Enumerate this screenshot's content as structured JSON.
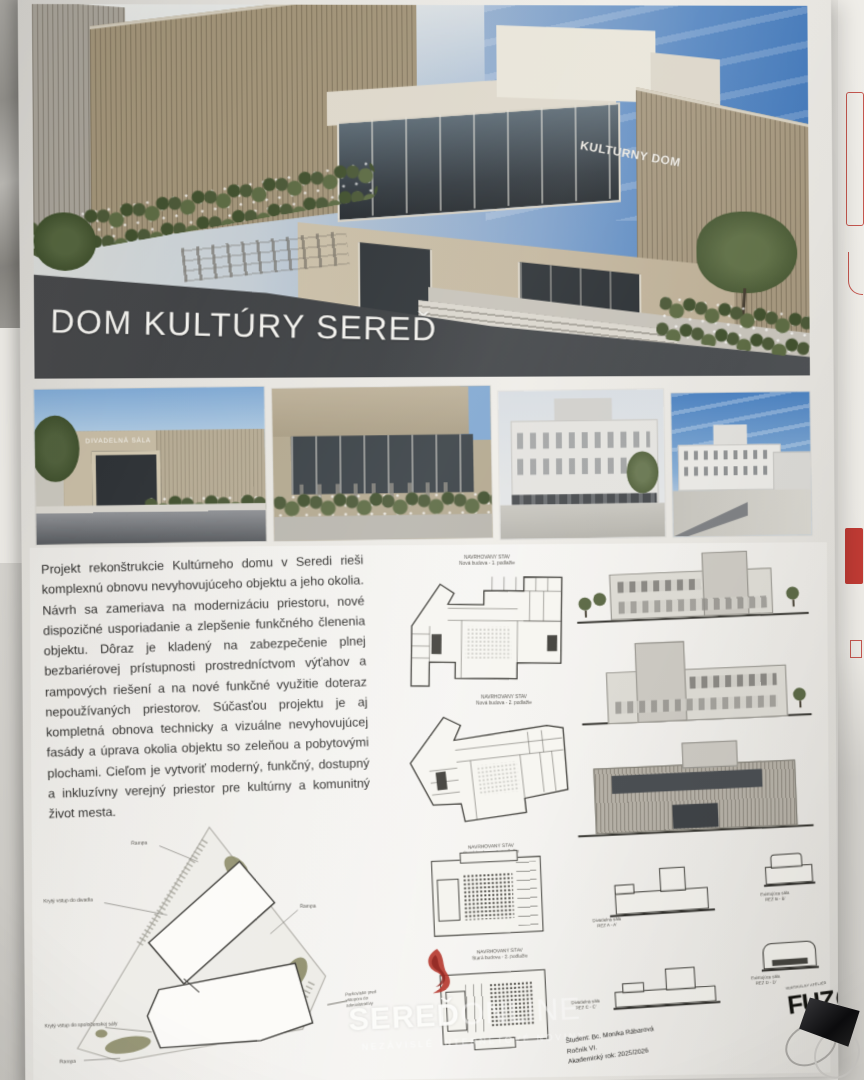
{
  "poster": {
    "hero": {
      "building_sign": "KULTURNY DOM",
      "title": "DOM KULTÚRY SEREĎ"
    },
    "thumbnails": {
      "theatre_sign": "DIVADELNÁ SÁLA"
    },
    "description": "Projekt rekonštrukcie Kultúrneho domu v Seredi rieši komplexnú obnovu nevyhovujúceho objektu a jeho okolia. Návrh sa zameriava na modernizáciu priestoru, nové dispozičné usporiadanie a zlepšenie funkčného členenia objektu. Dôraz je kladený na zabezpečenie plnej bezbariérovej prístupnosti prostredníctvom výťahov a rampových riešení a na nové funkčné využitie doteraz nepoužívaných priestorov. Súčasťou projektu je aj kompletná obnova technicky a vizuálne nevyhovujúcej fasády a úprava okolia objektu so zeleňou a pobytovými plochami. Cieľom je vytvoriť moderný, funkčný, dostupný a inkluzívny verejný priestor pre kultúrny a komunitný život mesta.",
    "plan_labels": [
      {
        "line1": "NAVRHOVANÝ STAV",
        "line2": "Nová budova - 1. podlažie"
      },
      {
        "line1": "NAVRHOVANÝ STAV",
        "line2": "Nová budova - 2. podlažie"
      },
      {
        "line1": "NAVRHOVANÝ STAV",
        "line2": "Stará budova - 1. podlažie"
      },
      {
        "line1": "NAVRHOVANÝ STAV",
        "line2": "Stará budova - 2. podlažie"
      }
    ],
    "site_plan": {
      "labels": {
        "ramp_top": "Rampa",
        "entry_theatre": "Krytý vstup do divadla",
        "ramp_right": "Rampa",
        "entry_hall": "Krytý vstup do spoločenskej sály",
        "ramp_bottom": "Rampa",
        "parking": "Parkovisko pred vstupom do administratívy"
      }
    },
    "section_labels": [
      {
        "line1": "Divadelná sála",
        "line2": "REZ A - A'"
      },
      {
        "line1": "Existujúca sála",
        "line2": "REZ B - B'"
      },
      {
        "line1": "Divadelná sála",
        "line2": "REZ C - C'"
      },
      {
        "line1": "Existujúca sála",
        "line2": "REZ D - D'"
      }
    ],
    "watermark": {
      "brand_strong": "SEREĎ",
      "brand_light": "ONLINE",
      "tagline": "NEZÁVISLÉ INTERNETOVÉ NOVINY"
    },
    "credits": {
      "student": "Študent: Bc. Monika Rábarová",
      "year": "Ročník VI.",
      "academic_year": "Akademický rok: 2025/2026"
    },
    "fuzo": {
      "atelier": "VERTIKÁLNY ATELIÉR",
      "wordmark": "FUZ"
    }
  },
  "colors": {
    "accent_red": "#b5382f",
    "sky_blue": "#4f86c2",
    "facade_tan": "#a99b82",
    "road_dark": "#3f4245",
    "ink": "#3a3a3a"
  }
}
